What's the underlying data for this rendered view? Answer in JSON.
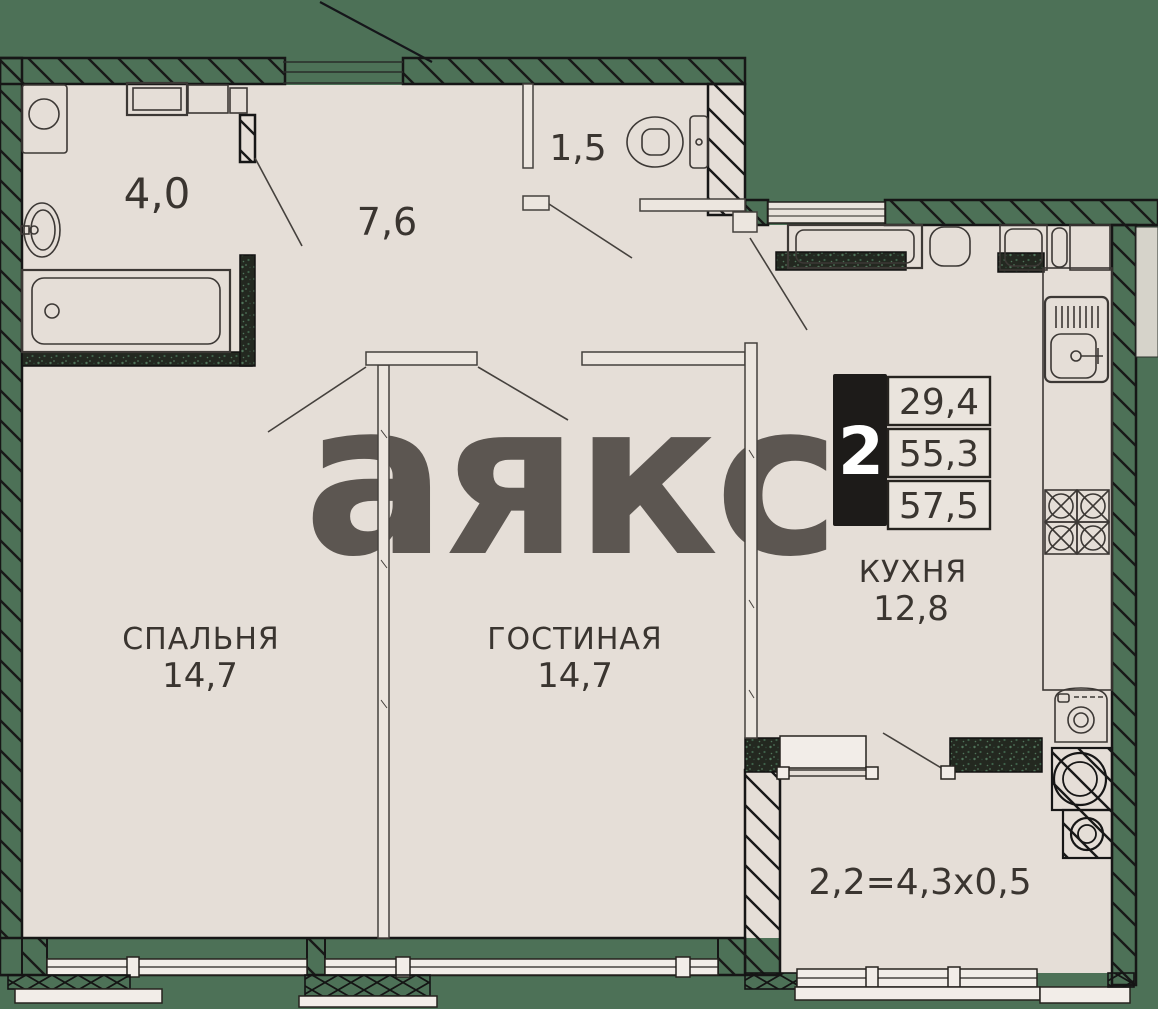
{
  "watermark": "аякс",
  "rooms": {
    "bathroom": {
      "area": "4,0"
    },
    "hallway": {
      "area": "7,6"
    },
    "toilet": {
      "area": "1,5"
    },
    "kitchen": {
      "name": "КУХНЯ",
      "area": "12,8"
    },
    "bedroom": {
      "name": "СПАЛЬНЯ",
      "area": "14,7"
    },
    "living_room": {
      "name": "ГОСТИНАЯ",
      "area": "14,7"
    },
    "balcony": {
      "dimensions": "2,2=4,3х0,5"
    }
  },
  "info_badge": {
    "room_count": "2",
    "values": [
      "29,4",
      "55,3",
      "57,5"
    ]
  },
  "colors": {
    "background_wall_green": "#4d7157",
    "floor": "#e5ded7",
    "outline": "#1a1a1a",
    "text": "#3a3530",
    "watermark": "#f1eae4",
    "wet_wall_dark": "#232820",
    "badge_black": "#1d1b19",
    "window_white": "#f2ede8"
  }
}
